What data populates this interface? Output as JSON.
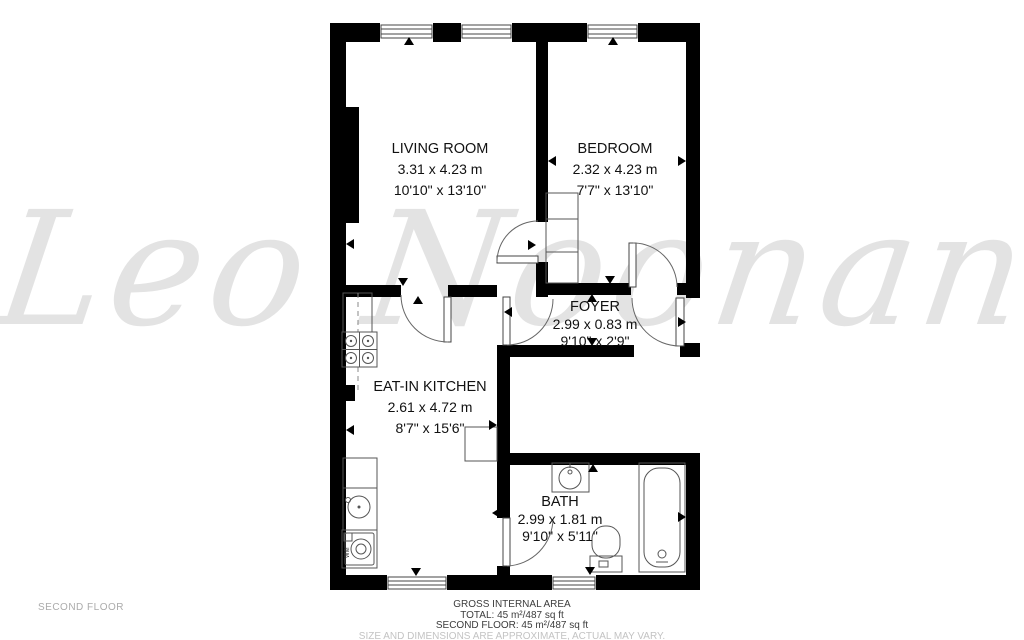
{
  "watermark": {
    "text": "Leo Noonan",
    "color": "#e3e3e3"
  },
  "floor_label": "SECOND FLOOR",
  "rooms": [
    {
      "name": "LIVING ROOM",
      "dim_m": "3.31 x 4.23 m",
      "dim_ft": "10'10\" x 13'10\""
    },
    {
      "name": "BEDROOM",
      "dim_m": "2.32 x 4.23 m",
      "dim_ft": "7'7\" x 13'10\""
    },
    {
      "name": "FOYER",
      "dim_m": "2.99 x 0.83 m",
      "dim_ft": "9'10\" x 2'9\""
    },
    {
      "name": "EAT-IN KITCHEN",
      "dim_m": "2.61 x 4.72 m",
      "dim_ft": "8'7\" x 15'6\""
    },
    {
      "name": "BATH",
      "dim_m": "2.99 x 1.81 m",
      "dim_ft": "9'10\" x 5'11\""
    }
  ],
  "appliances": {
    "washing_machine_label": "WM"
  },
  "fixtures": [
    "stove",
    "kitchen-sink",
    "washing-machine",
    "kitchen-table",
    "closet",
    "bath-sink",
    "toilet",
    "bathtub"
  ],
  "footer": {
    "title": "GROSS INTERNAL AREA",
    "total": "TOTAL: 45 m²/487 sq ft",
    "floor_total": "SECOND FLOOR: 45 m²/487 sq ft",
    "disclaimer": "SIZE AND DIMENSIONS ARE APPROXIMATE, ACTUAL MAY VARY."
  },
  "colors": {
    "wall": "#000000",
    "fixture_line": "#555555",
    "watermark": "#e3e3e3"
  }
}
